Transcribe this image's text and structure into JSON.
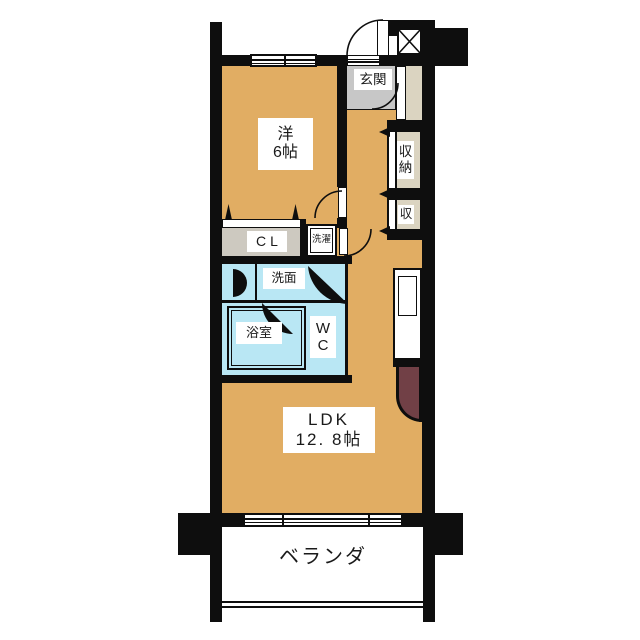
{
  "plan": {
    "title": "1LDK apartment floor plan",
    "rooms": {
      "western_room": {
        "line1": "洋",
        "line2": "6帖"
      },
      "entrance": {
        "label": "玄関"
      },
      "storage_large": {
        "line1": "収",
        "line2": "納"
      },
      "storage_small": {
        "label": "収"
      },
      "closet": {
        "label": "CL"
      },
      "laundry": {
        "label": "洗濯"
      },
      "washroom": {
        "label": "洗面"
      },
      "bathroom": {
        "label": "浴室"
      },
      "toilet": {
        "line1": "W",
        "line2": "C"
      },
      "ldk": {
        "line1": "LDK",
        "line2": "12. 8帖"
      },
      "veranda": {
        "label": "ベランダ"
      }
    },
    "colors": {
      "floor_tan": "#e1ad63",
      "entrance_gray": "#c7c7c7",
      "closet_beige": "#dbd4c1",
      "closet_interior_gray": "#cdc9c0",
      "wet_area_blue": "#b9e7f4",
      "counter_maroon": "#714046",
      "wall_black": "#0e0e0e"
    }
  }
}
